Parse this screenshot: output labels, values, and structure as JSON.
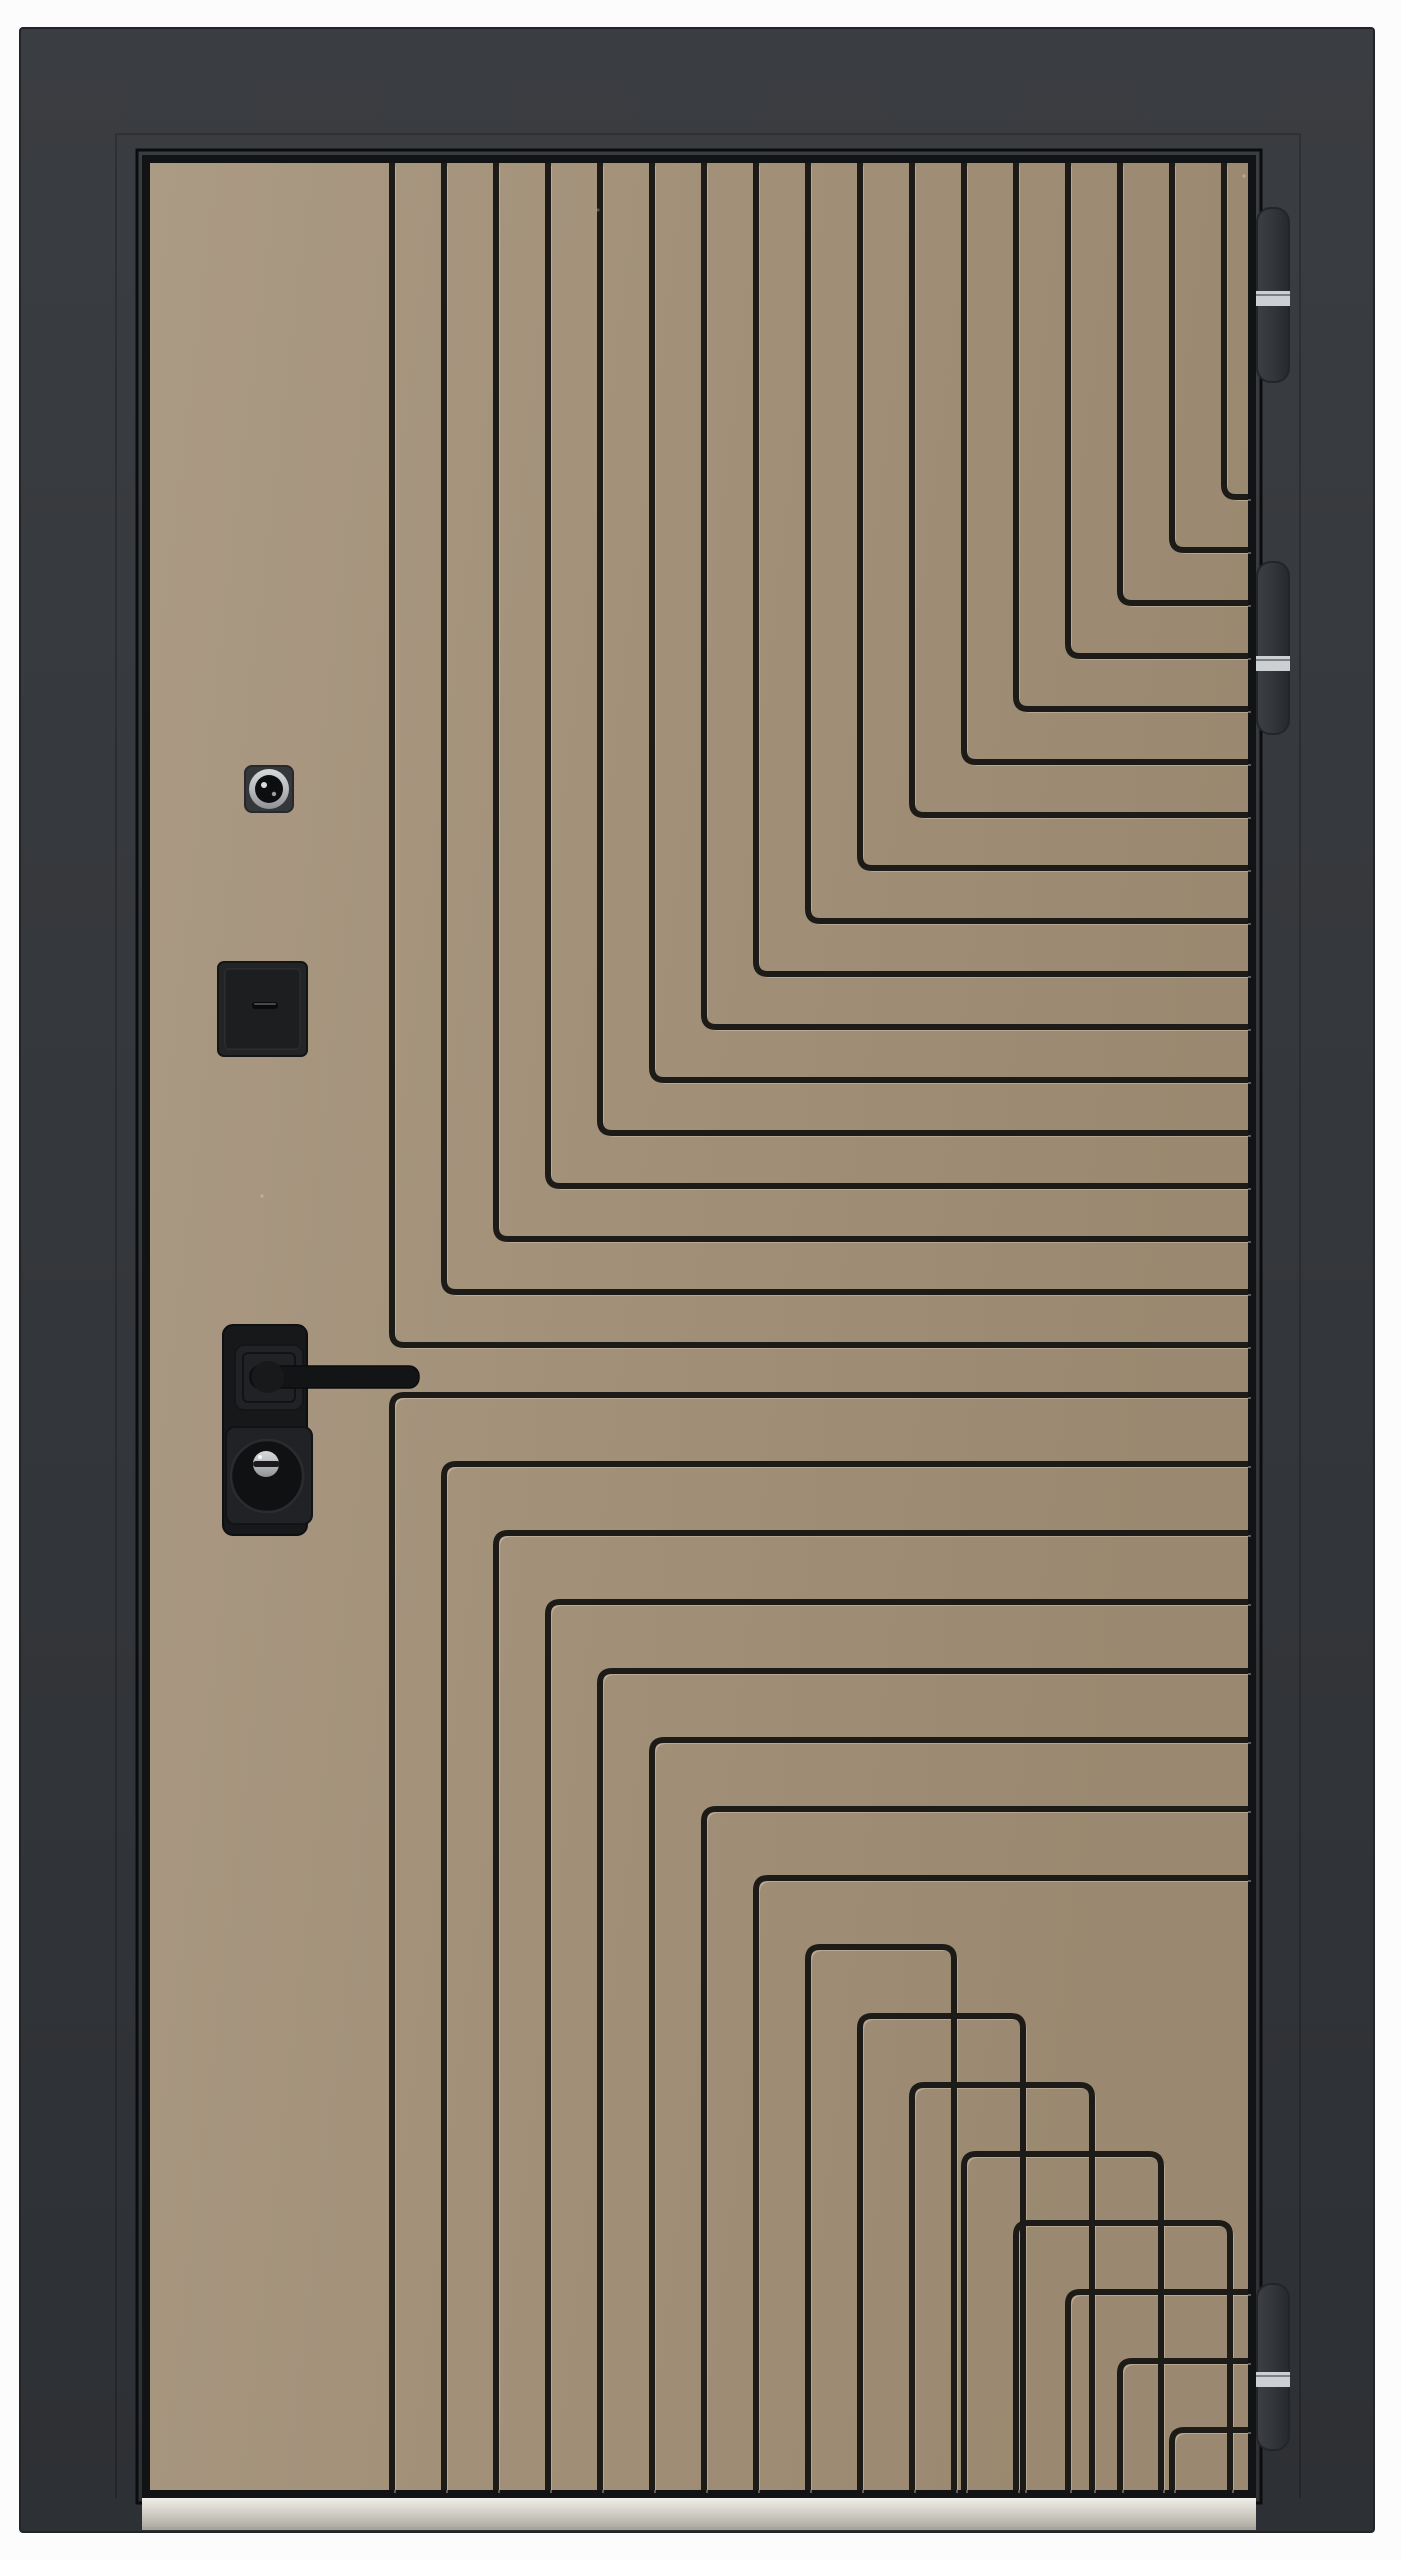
{
  "image": {
    "width": 1401,
    "height": 2560,
    "background": "#fcfcfc",
    "subject": "modern steel entry door, front view, dark charcoal frame, taupe leaf with black L-groove maze pattern"
  },
  "colors": {
    "background": "#fcfcfc",
    "frame_top": "#3a3d41",
    "frame_bottom": "#2d3034",
    "frame_edge": "#222427",
    "panel_border": "#121315",
    "leaf_gap": "#0b0c0d",
    "beige_light": "#ab9a84",
    "beige_mid": "#a18f77",
    "beige_dark": "#9a8970",
    "groove": "#1c1b18",
    "groove_highlight": "rgba(225,214,196,0.38)",
    "hardware_black": "#17181a",
    "hardware_black2": "#212225",
    "hardware_darkest": "#101113",
    "silver_light": "#d6d9da",
    "silver_mid": "#b9bcbe",
    "silver_dark": "#8e9295",
    "hinge_body": "#33363a",
    "hinge_edge": "#232529",
    "hinge_band": "#ccd0d2",
    "threshold_top": "#f0eee8",
    "threshold_front": "#cbc8c0",
    "threshold_line": "#a7a49c"
  },
  "frame": {
    "x": 20,
    "y": 28,
    "w": 1354,
    "h": 2504,
    "step_left_x": 116,
    "step_right_x": 1300,
    "step_top_y": 134
  },
  "panel": {
    "border": {
      "x": 142,
      "y": 155,
      "w": 1114,
      "h": 2343
    },
    "beige": {
      "x": 150,
      "y": 163,
      "w": 1098,
      "h": 2327
    }
  },
  "pattern": {
    "groove_width": 6,
    "highlight_width": 2,
    "highlight_offset": 3,
    "corner_radius": 12,
    "top_group": {
      "count": 17,
      "x0": 392,
      "dx": 52,
      "y0": 1345,
      "dy": -53,
      "edge_y": 163,
      "right_x": 1248
    },
    "bottom_group": {
      "count": 16,
      "x0": 392,
      "dx": 52,
      "y0": 1395,
      "dy": 69,
      "edge_y": 2490,
      "right_x": 1248,
      "turn_from": 8,
      "turn_to": 12,
      "turn_x0": 402,
      "turn_dx": 69
    }
  },
  "peephole": {
    "square": {
      "x": 245,
      "y": 766,
      "w": 48,
      "h": 46,
      "r": 7
    },
    "lens_cx": 269,
    "lens_cy": 789,
    "lens_r": 20,
    "inner_r": 14
  },
  "reader_box": {
    "x": 218,
    "y": 962,
    "w": 89,
    "h": 94,
    "r": 6,
    "inset": 7,
    "slot": {
      "x": 252,
      "y": 1002,
      "w": 26,
      "h": 7,
      "r": 3
    }
  },
  "handle": {
    "plate": {
      "x": 223,
      "y": 1325,
      "w": 84,
      "h": 210,
      "r": 10
    },
    "rosette": {
      "x": 235,
      "y": 1345,
      "w": 68,
      "h": 65,
      "r": 9
    },
    "lever": {
      "x": 250,
      "y": 1366,
      "tip_x": 419,
      "h": 22,
      "r": 10,
      "boss_x": 268,
      "boss_y": 1377,
      "boss_r": 16
    },
    "escutcheon": {
      "x": 226,
      "y": 1427,
      "w": 86,
      "h": 97,
      "r": 9
    },
    "cylinder": {
      "cx": 267,
      "cy": 1476,
      "r": 36
    },
    "key_disc": {
      "cx": 266,
      "cy": 1464,
      "r": 13
    },
    "keyway": {
      "x": 253,
      "y": 1461,
      "w": 27,
      "h": 6,
      "r": 3
    }
  },
  "hinges": {
    "x": 1257,
    "w": 32,
    "r": 14,
    "band_h": 15,
    "items": [
      {
        "y1": 208,
        "y2": 382,
        "band_y": 291
      },
      {
        "y1": 562,
        "y2": 734,
        "band_y": 656
      },
      {
        "y1": 2284,
        "y2": 2450,
        "band_y": 2372
      }
    ]
  },
  "threshold": {
    "x": 142,
    "y": 2498,
    "w": 1114,
    "h": 32
  },
  "specks": [
    {
      "x": 598,
      "y": 210
    },
    {
      "x": 1244,
      "y": 176
    },
    {
      "x": 262,
      "y": 1196
    }
  ]
}
